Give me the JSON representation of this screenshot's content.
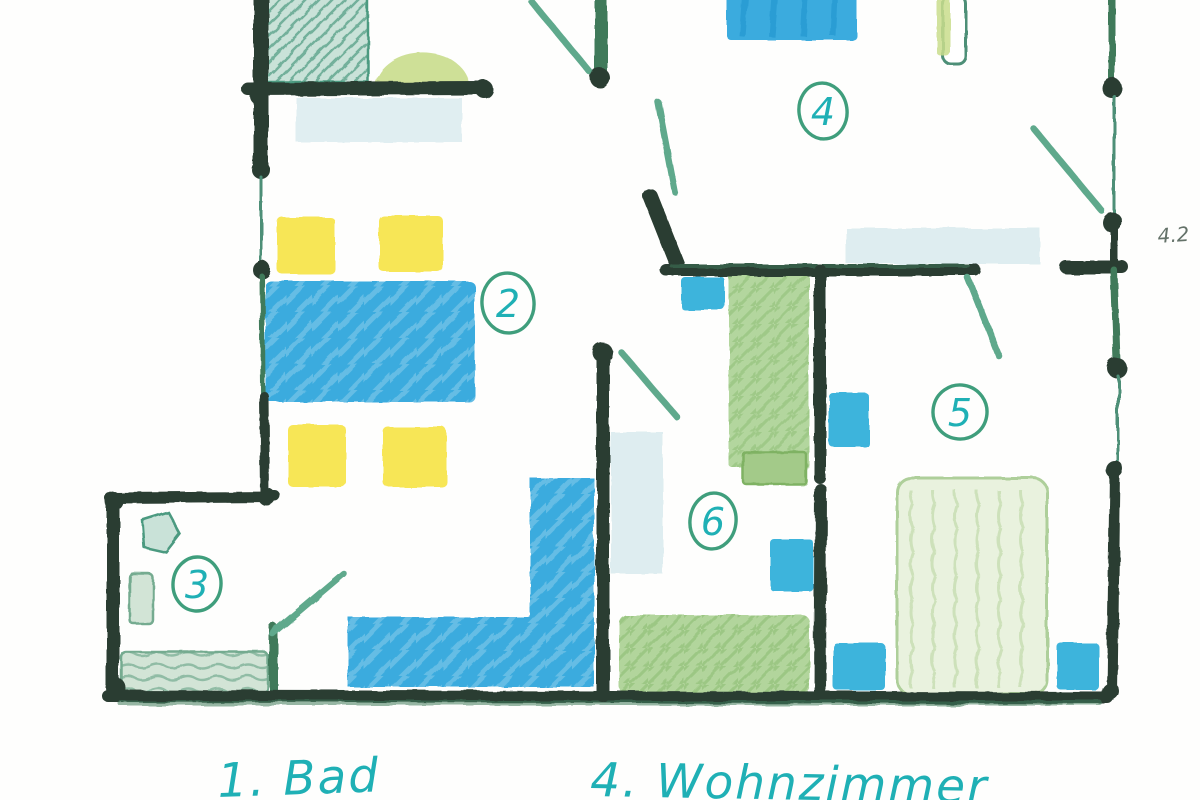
{
  "title": "Hand-drawn apartment floor plan sketch",
  "rooms": {
    "room2": {
      "number": "2"
    },
    "room3": {
      "number": "3"
    },
    "room4": {
      "number": "4"
    },
    "room5": {
      "number": "5"
    },
    "room6": {
      "number": "6"
    }
  },
  "legend": {
    "bad": "1. Bad",
    "wohnzimmer": "4. Wohnzimmer"
  },
  "margin_note": "4.2",
  "colors": {
    "wall": "#2c3e33",
    "wall_green": "#3f7a5a",
    "door": "#5fa98c",
    "window": "#4e8f77",
    "blue": "#3aabde",
    "cyan": "#3eb4dc",
    "pale_blue": "#d6e8ec",
    "yellow": "#f6e449",
    "yellow_green": "#c9dd8c",
    "teal_fill": "#c9e2d8",
    "teal_stroke": "#4c9a80",
    "green": "#abd194",
    "green_dark": "#7fb264",
    "bed_fill": "#e9f2de",
    "bed_stroke": "#aecf9a",
    "bath_fill": "#d2e4d6",
    "bath_stroke": "#74ab90",
    "ink": "#1fb0b5",
    "circle": "#3f9e7c",
    "note": "#4a5a50"
  }
}
